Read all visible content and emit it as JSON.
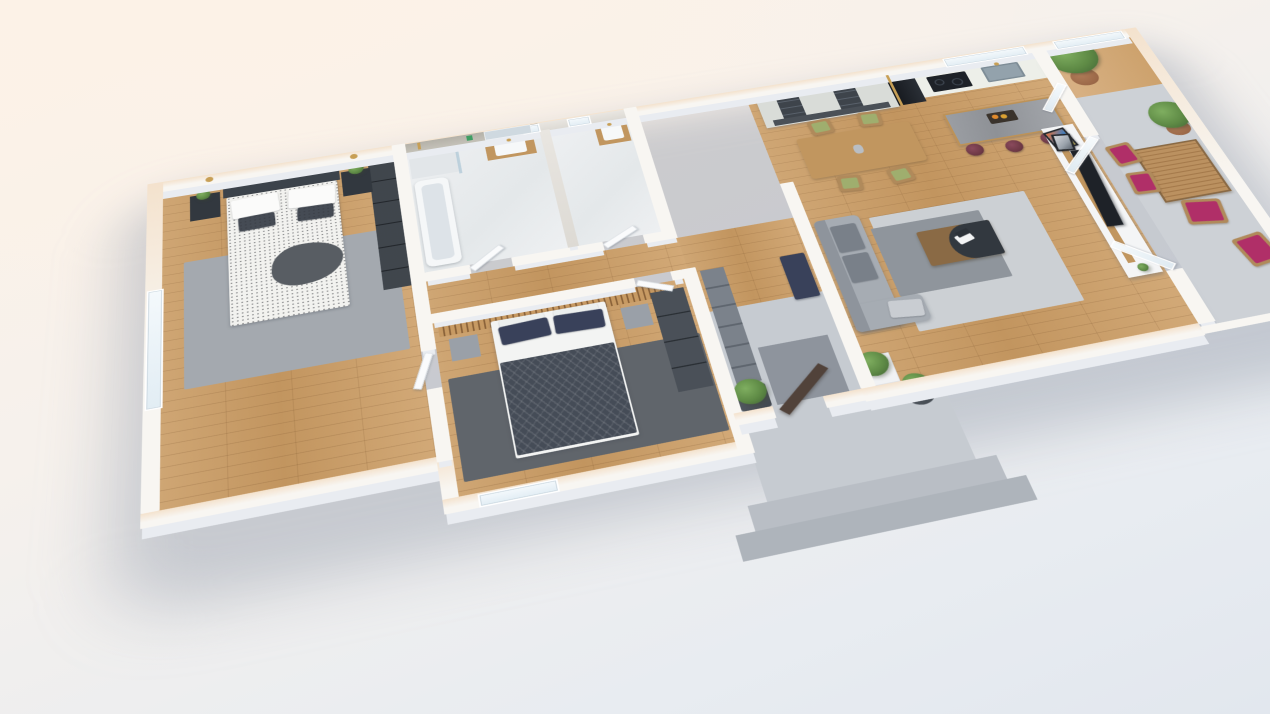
{
  "title": "3D Apartment Floor Plan Render",
  "view": "isometric-cutaway-3d-render",
  "palette": {
    "bgTop": "#fcf2e7",
    "bgMid": "#f6f1ec",
    "bgBot": "#e8ecf1",
    "wallTop": "#f8f6f2",
    "wallCream": "#f4e2cd",
    "wallSkirt": "#e9ecf1",
    "marble": "#eef0f2",
    "concrete": "#c6cbd1",
    "step": "#b9bec5",
    "mat": "#8e949d",
    "dark": "#32383f",
    "dark2": "#3c434b",
    "closet": "#7b828b",
    "woodF": "#c1965f",
    "woodD": "#8a6a45",
    "bed1": "#f2f2ef",
    "throw": "#585d63",
    "bed2": "#454c57",
    "sheet": "#f3f4f3",
    "navy": "#39415a",
    "rug1": "#a4a9af",
    "rugDark": "#60656b",
    "rugLight": "#ccd0d4",
    "shelfU": "#d9dcd8",
    "cubby": "#3e444b",
    "island": "#96999e",
    "stool": "#6d3845",
    "magenta": "#b02f68",
    "green": "#5e8a45",
    "greenD": "#3f6134",
    "pot": "#9b6848",
    "doorBrown": "#51423a",
    "gold": "#c79f55",
    "tv": "#1e2228",
    "sofa": "#a6acb3",
    "sofaD": "#8e949c",
    "steel": "#93a2ac"
  },
  "scene": {
    "rooms": [
      {
        "name": "master-bedroom",
        "floor": "oak-wood",
        "furniture": [
          "double-bed-speckled-duvet",
          "dark-headboard",
          "two-nightstands",
          "potted-plants",
          "two-gold-wall-sconces",
          "gray-rug",
          "dark-wardrobe",
          "window"
        ]
      },
      {
        "name": "bathroom",
        "floor": "white-marble",
        "furniture": [
          "bathtub",
          "walk-in-shower-brass-fixture",
          "wood-vanity-white-sink",
          "mirror",
          "windows"
        ]
      },
      {
        "name": "toilet-room",
        "floor": "white-marble",
        "furniture": [
          "wood-vanity-white-sink",
          "window"
        ]
      },
      {
        "name": "second-bedroom",
        "floor": "oak-wood",
        "furniture": [
          "double-bed-dark-palm-duvet",
          "wood-slat-headboard-wall",
          "two-gray-nightstands",
          "dark-rug",
          "dark-wardrobe",
          "window"
        ]
      },
      {
        "name": "hallway-entry",
        "floor": "wood-and-concrete",
        "furniture": [
          "gray-closets",
          "navy-tufted-bench",
          "open-brown-front-door",
          "potted-shrubs"
        ]
      },
      {
        "name": "living-dining-kitchen",
        "floor": "oak-wood",
        "furniture": [
          "shelving-wall-unit",
          "dark-fridge-column",
          "kitchen-counter-sink-cooktop",
          "kitchen-window",
          "marble-island-fruit-bowl",
          "three-burgundy-bar-stools",
          "dining-table",
          "four-green-cushion-chairs",
          "gray-sofa",
          "coffee-table-with-laptop",
          "area-rugs",
          "white-tv-wall-unit",
          "flat-tv",
          "leaning-picture-frames",
          "open-balcony-doors"
        ]
      },
      {
        "name": "balcony",
        "floor": "concrete-and-wood",
        "furniture": [
          "wood-slat-table",
          "chairs-with-magenta-cushions",
          "potted-trees"
        ]
      },
      {
        "name": "entrance-porch",
        "floor": "concrete",
        "furniture": [
          "two-steps",
          "potted-shrub"
        ]
      }
    ]
  }
}
